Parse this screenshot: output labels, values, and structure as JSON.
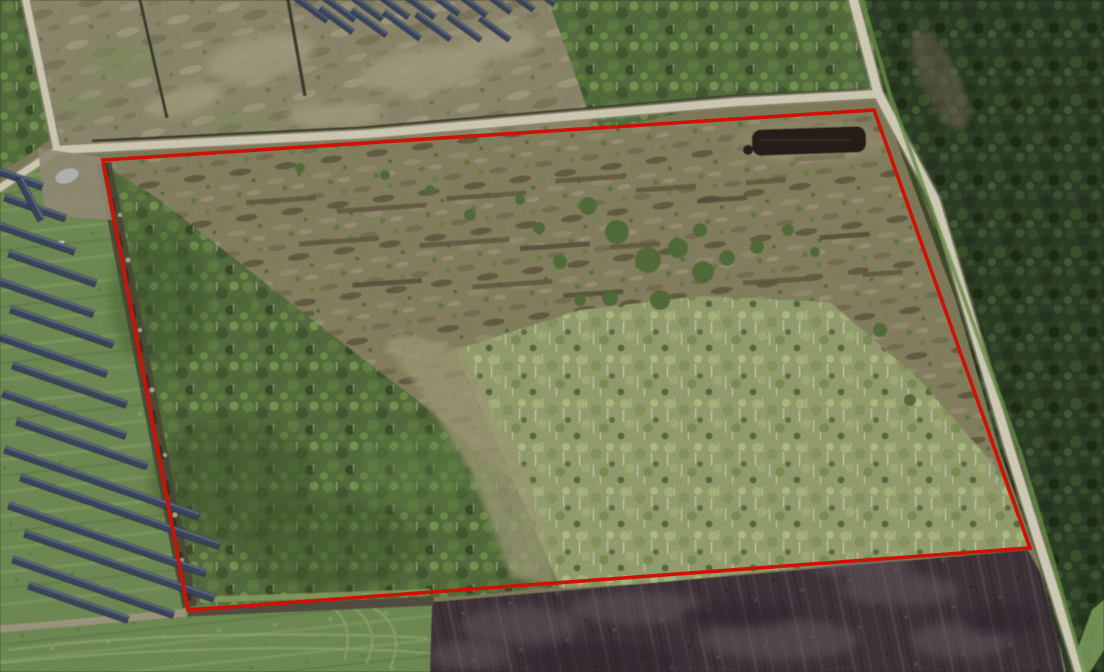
{
  "scene": {
    "type": "aerial-orthophoto",
    "description": "Spring aerial photograph of a rural land parcel outlined with a red cadastral boundary, bordered by light dirt roads, a solar farm with panel rows to the west, dense forest to the east, clear-cut scrub inside the parcel, a dark peat pit near the north-east corner, a dark plowed field to the south and green grass fields to the south-west",
    "canvas": {
      "width": 1104,
      "height": 672
    }
  },
  "boundary": {
    "name": "parcel-boundary",
    "points": "103,160 874,110 1030,548 188,610",
    "stroke": "#ee1506",
    "stroke_width": 3.6
  },
  "colors": {
    "road": "#eae4cc",
    "road_shoulder": "#b4ab8c",
    "scrub": "#96906c",
    "north_field": "#9d9779",
    "forest_dark": "#33452a",
    "forest_medium": "#5e7a45",
    "birch": "#a7b27b",
    "grass": "#7d9c5e",
    "grass_bright": "#8fb369",
    "plow": "#463a41",
    "mud": "#5d564a",
    "debris_strip": "#554f3d",
    "panel": "#42506a",
    "panel_highlight": "#687892",
    "pit": "#2b231d",
    "ditch": "#3f4530",
    "verge_green": "#74a04d",
    "pale_lane": "#b2ae85"
  },
  "solar_arrays": [
    {
      "name": "solar-array-west",
      "angle": 19,
      "row_height": 7.5,
      "rows": [
        [
          0,
          168,
          46
        ],
        [
          6,
          194,
          64
        ],
        [
          0,
          222,
          80
        ],
        [
          10,
          250,
          92
        ],
        [
          0,
          278,
          100
        ],
        [
          12,
          306,
          108
        ],
        [
          2,
          334,
          112
        ],
        [
          14,
          362,
          120
        ],
        [
          4,
          390,
          130
        ],
        [
          18,
          418,
          138
        ],
        [
          6,
          446,
          205
        ],
        [
          22,
          474,
          210
        ],
        [
          10,
          502,
          208
        ],
        [
          26,
          530,
          200
        ],
        [
          14,
          556,
          170
        ],
        [
          30,
          582,
          105
        ],
        [
          22,
          176,
          48,
          62
        ]
      ]
    },
    {
      "name": "solar-array-north",
      "angle": 36,
      "row_height": 6,
      "rows": [
        [
          290,
          -10,
          48
        ],
        [
          316,
          -12,
          50
        ],
        [
          342,
          -14,
          52
        ],
        [
          368,
          -16,
          52
        ],
        [
          394,
          -16,
          52
        ],
        [
          420,
          -18,
          50
        ],
        [
          446,
          -18,
          52
        ],
        [
          472,
          -20,
          50
        ],
        [
          498,
          -20,
          46
        ],
        [
          524,
          -22,
          40
        ],
        [
          322,
          6,
          40
        ],
        [
          354,
          8,
          42
        ],
        [
          386,
          10,
          44
        ],
        [
          418,
          12,
          42
        ],
        [
          450,
          14,
          40
        ],
        [
          482,
          16,
          36
        ]
      ]
    }
  ],
  "features": [
    {
      "name": "parcel-boundary",
      "kind": "annotation-overlay"
    },
    {
      "name": "dirt-road-west",
      "kind": "road"
    },
    {
      "name": "dirt-road-north",
      "kind": "road"
    },
    {
      "name": "dirt-road-east",
      "kind": "road"
    },
    {
      "name": "solar-array-west",
      "kind": "solar-farm"
    },
    {
      "name": "solar-array-north",
      "kind": "solar-farm"
    },
    {
      "name": "north-clearcut-field",
      "kind": "vegetation"
    },
    {
      "name": "parcel-scrub",
      "kind": "vegetation"
    },
    {
      "name": "west-forest",
      "kind": "vegetation"
    },
    {
      "name": "birch-stand",
      "kind": "vegetation"
    },
    {
      "name": "northeast-forest",
      "kind": "vegetation"
    },
    {
      "name": "east-forest",
      "kind": "vegetation"
    },
    {
      "name": "peat-pit",
      "kind": "excavation"
    },
    {
      "name": "plowed-field",
      "kind": "agriculture"
    },
    {
      "name": "south-grass-field",
      "kind": "agriculture"
    },
    {
      "name": "west-grass-field",
      "kind": "agriculture"
    }
  ]
}
